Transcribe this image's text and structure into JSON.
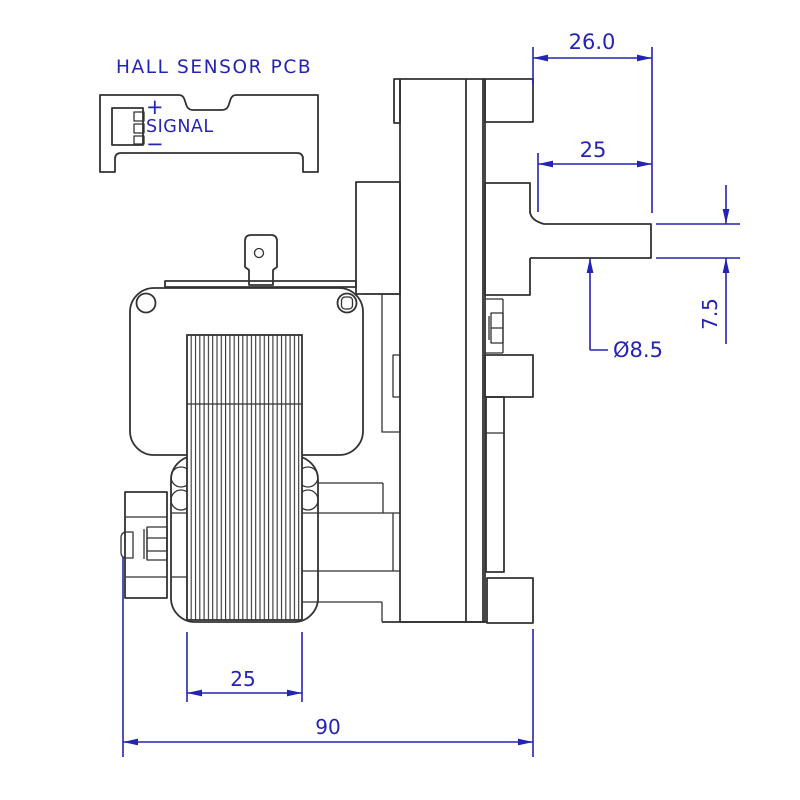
{
  "drawing": {
    "background": "#ffffff",
    "line_color": "#323232",
    "dimension_color": "#2424b4",
    "pcb": {
      "title": "HALL SENSOR PCB",
      "pin_plus": "+",
      "pin_signal": "SIGNAL",
      "pin_minus": "−",
      "connector_pins": 3
    },
    "dimensions": {
      "gearbox_to_shaft_end": "26.0",
      "shaft_length": "25",
      "shaft_height": "7.5",
      "shaft_diameter": "Ø8.5",
      "stack_width": "25",
      "overall_length": "90"
    }
  }
}
